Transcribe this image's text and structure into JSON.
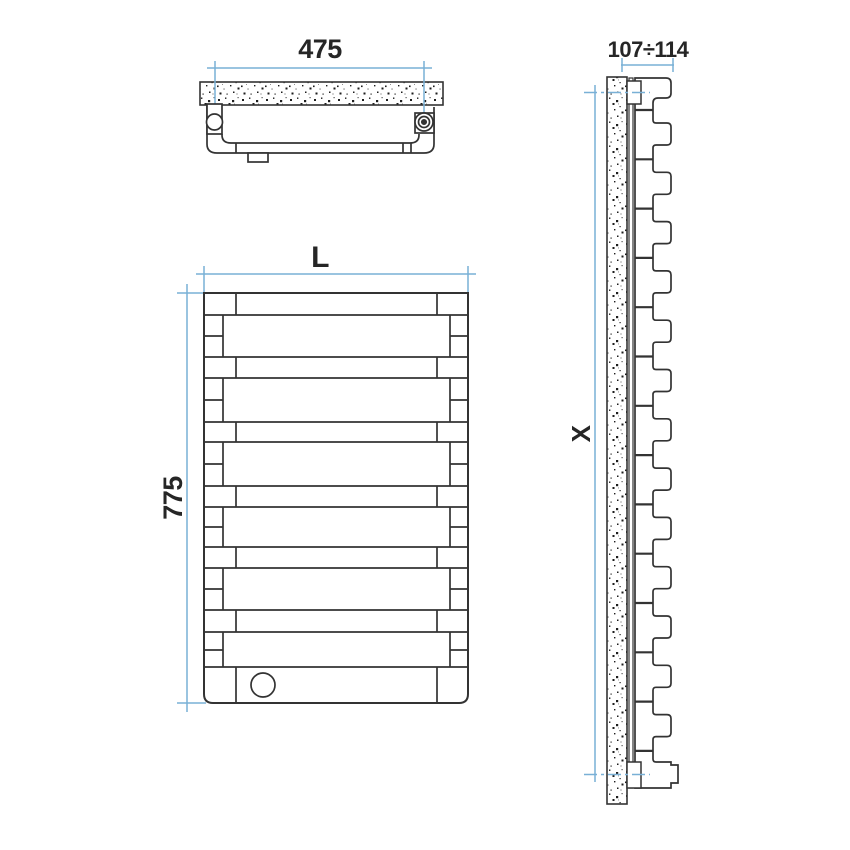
{
  "drawing": {
    "labels": {
      "top_width": "475",
      "depth_range": "107÷114",
      "front_width": "L",
      "front_height": "775",
      "side_height": "X"
    },
    "colors": {
      "outline": "#333333",
      "dimension_blue": "#79b0d6",
      "label_text": "#262626",
      "background": "#ffffff",
      "speckle": "#1e1e1e"
    }
  }
}
